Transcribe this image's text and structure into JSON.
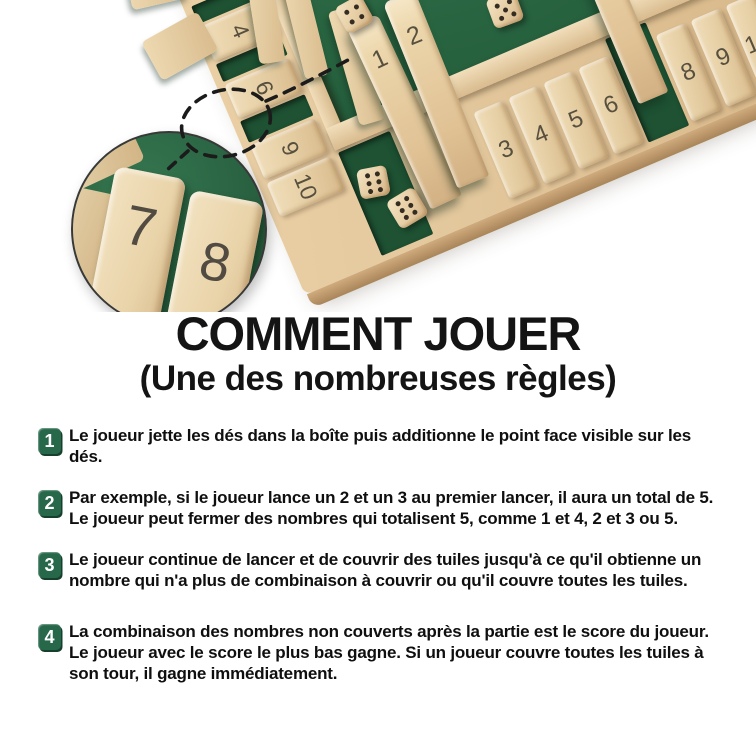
{
  "title": {
    "heading": "COMMENT JOUER",
    "subheading": "(Une des nombreuses règles)"
  },
  "photo": {
    "description": "Jeu Shut the Box en bois 4 joueurs avec tuiles numérotées et dés sur feutre vert",
    "board": {
      "left_tiles": [
        "4",
        "6",
        "9",
        "10"
      ],
      "bottom_tiles": [
        "1",
        "2",
        "3",
        "4",
        "5",
        "6",
        "7",
        "8",
        "9",
        "10"
      ],
      "standing_tiles": [
        "1",
        "2",
        "7"
      ],
      "dice": [
        {
          "name": "felt-die-left",
          "value": 4
        },
        {
          "name": "felt-die-right",
          "value": 5
        },
        {
          "name": "corner-die-1",
          "value": 6
        },
        {
          "name": "corner-die-2",
          "value": 6
        },
        {
          "name": "right-die-1",
          "value": 3
        },
        {
          "name": "right-die-2",
          "value": 6
        }
      ]
    },
    "inset": {
      "tiles": [
        "7",
        "8"
      ]
    },
    "colors": {
      "felt": "#2b6844",
      "felt_shadow": "#1e5233",
      "wood": "#e6cba0",
      "wood_light": "#f0deba",
      "wood_dark": "#c8a274",
      "tile_number": "#57503f",
      "pip": "#352c22",
      "inset_border": "#383838",
      "dash": "#1b1b1b",
      "badge_green": "#27684a"
    }
  },
  "instructions": [
    {
      "number": "1",
      "text": "Le joueur jette les dés dans la boîte puis additionne le point face visible sur les dés."
    },
    {
      "number": "2",
      "text": "Par exemple, si le joueur lance un 2 et un 3 au premier lancer, il aura un total de 5. Le joueur peut fermer des nombres qui totalisent 5, comme 1 et 4, 2 et 3 ou 5."
    },
    {
      "number": "3",
      "text": "Le joueur continue de lancer et de couvrir des tuiles jusqu'à ce qu'il obtienne un nombre qui n'a plus de combinaison à couvrir ou qu'il couvre toutes les tuiles."
    },
    {
      "number": "4",
      "text": "La combinaison des nombres non couverts après la partie est le score du joueur. Le joueur avec le score le plus bas gagne. Si un joueur couvre toutes les tuiles à son tour, il gagne immédiatement."
    }
  ]
}
